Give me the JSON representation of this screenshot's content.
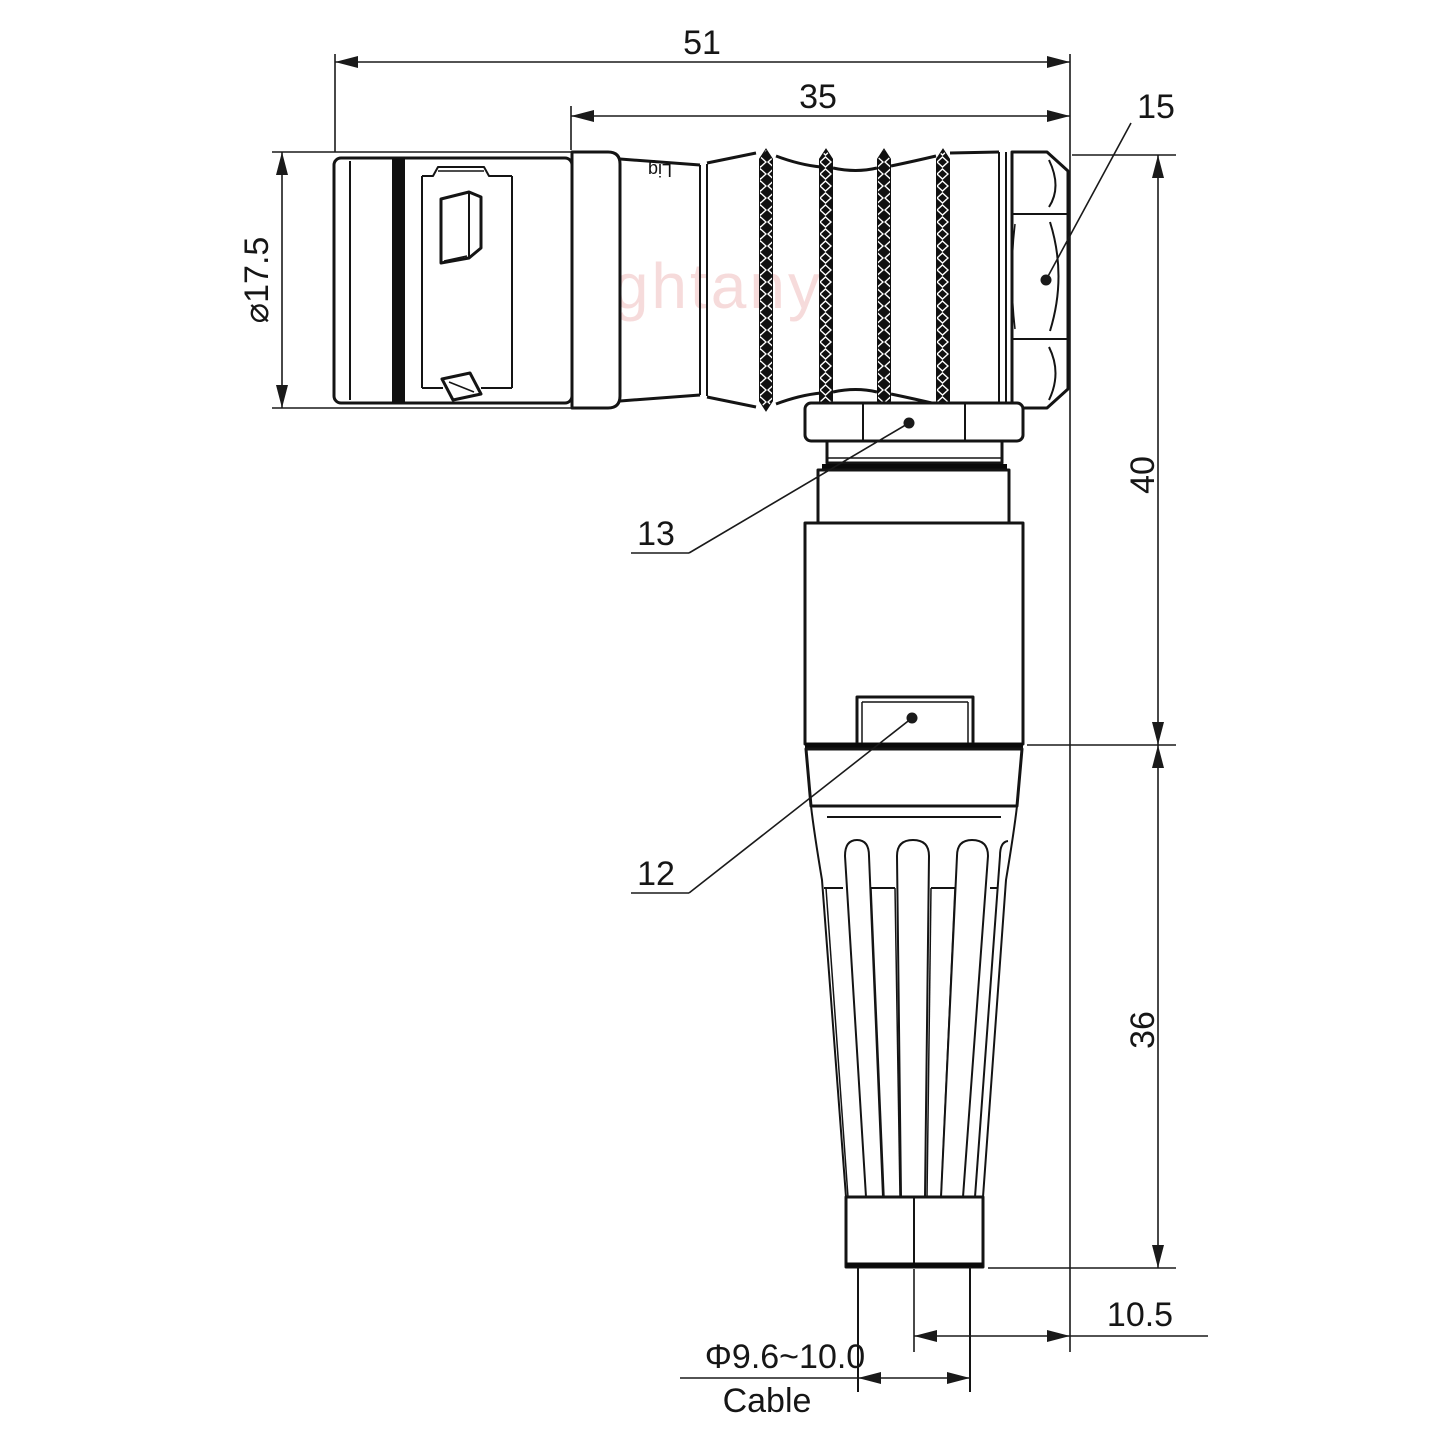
{
  "watermark": {
    "text": "Lightany"
  },
  "body_print": {
    "text": "Lig"
  },
  "dimensions": {
    "overall_length": "51",
    "rear_length": "35",
    "front_diameter": "⌀17.5",
    "upper_height": "40",
    "lower_height": "36",
    "cable_offset": "10.5",
    "cable_diameter": "Φ9.6~10.0"
  },
  "callouts": {
    "hex_nut": "15",
    "coupling_nut": "13",
    "latch": "12"
  },
  "labels": {
    "cable": "Cable"
  },
  "colors": {
    "line": "#141414",
    "watermark": "#efb9b9",
    "background": "#ffffff"
  }
}
